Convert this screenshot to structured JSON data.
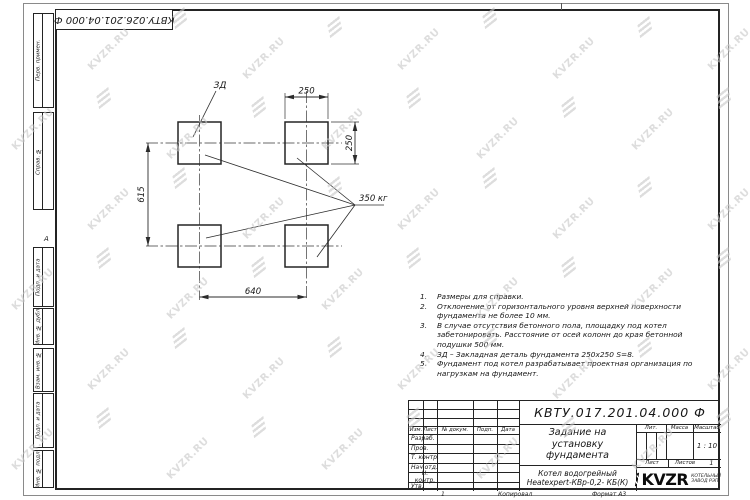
{
  "watermark": {
    "text": "KVZR.RU"
  },
  "corner_stamp": {
    "doc_number": "КВТУ.026.201.04.000 Ф"
  },
  "margin_labels": [
    "Перв. примен.",
    "Справ. №",
    "Подп. и дата",
    "Инв. № дубл.",
    "Взам. инв. №",
    "Подп. и дата",
    "Инв. № подл."
  ],
  "zone_marker": "А",
  "drawing": {
    "detail_label": "ЗД",
    "load_label": "350 кг",
    "dims": {
      "top": "250",
      "right": "250",
      "left": "615",
      "bottom": "640"
    }
  },
  "notes": [
    {
      "num": "1.",
      "text": "Размеры для справки."
    },
    {
      "num": "2.",
      "text": "Отклонение от горизонтального уровня верхней поверхности фундамента не более 10 мм."
    },
    {
      "num": "3.",
      "text": "В случае отсутствия бетонного пола, площадку под котел забетонировать. Расстояние от осей колонн до края бетонной подушки 500 мм."
    },
    {
      "num": "4.",
      "text": "ЗД – Закладная деталь фундамента 250х250 S=8."
    },
    {
      "num": "5.",
      "text": "Фундамент под котел разрабатывает проектная организация по нагрузкам на фундамент."
    }
  ],
  "title_block": {
    "doc_number": "КВТУ.017.201.04.000 Ф",
    "title": "Задание на установку фундамента",
    "product_line1": "Котел водогрейный",
    "product_line2": "Heatexpert-КВр-0,2- КБ(К)",
    "headers": {
      "izm": "Изм.",
      "list": "Лист",
      "n_dokum": "№ докум.",
      "podp": "Подп.",
      "data": "Дата",
      "lit": "Лит.",
      "massa": "Масса",
      "masshtab": "Масштаб",
      "list2": "Лист",
      "listov": "Листов"
    },
    "rows": [
      "Разраб.",
      "Пров.",
      "Т. контр.",
      "Нач.отд.",
      "Н. контр.",
      "Утв."
    ],
    "scale": "1 : 10",
    "sheets_count": "1",
    "logo_text": "KVZR",
    "logo_sub1": "КОТЕЛЬНЫЙ",
    "logo_sub2": "ЗАВОД РЭП"
  },
  "footer": {
    "left_num": "1",
    "kopiroval": "Копировал",
    "format": "Формат А3"
  }
}
